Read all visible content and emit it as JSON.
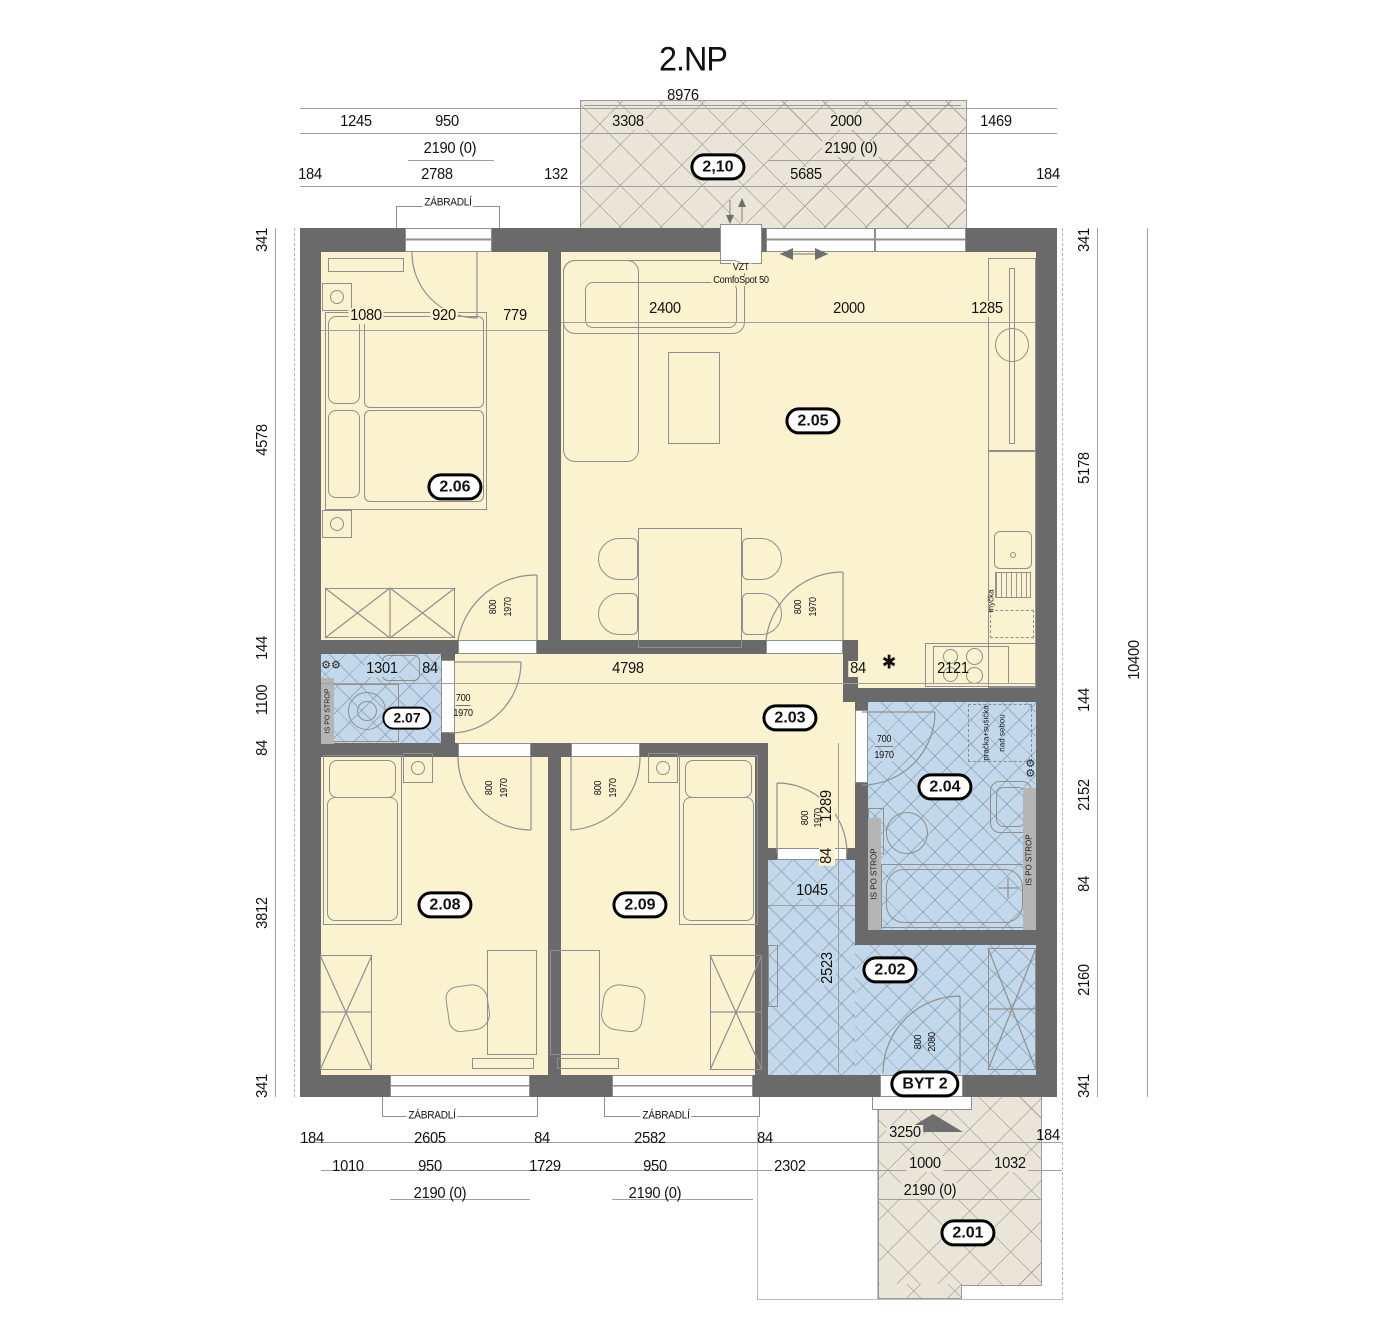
{
  "title": "2.NP",
  "rooms": {
    "r210": "2,10",
    "r205": "2.05",
    "r206": "2.06",
    "r207": "2.07",
    "r203": "2.03",
    "r204": "2.04",
    "r208": "2.08",
    "r209": "2.09",
    "r202": "2.02",
    "r201": "2.01",
    "byt": "BYT 2"
  },
  "dims": {
    "top_total": "8976",
    "t1a": "1245",
    "t1b": "950",
    "t1c": "3308",
    "t1d": "2000",
    "t1e": "1469",
    "t2a": "2190 (0)",
    "t2b": "2190 (0)",
    "t3a": "184",
    "t3b": "2788",
    "t3c": "132",
    "t3d": "5685",
    "t3e": "184",
    "l1": "341",
    "l2": "4578",
    "l3": "144",
    "l4": "1100",
    "l5": "84",
    "l6": "3812",
    "l7": "341",
    "r1": "341",
    "r2": "5178",
    "r3": "144",
    "r4": "2152",
    "r5": "84",
    "r6": "2160",
    "r7": "341",
    "right_total": "10400",
    "m206a": "1080",
    "m206b": "920",
    "m206c": "779",
    "m205a": "2400",
    "m205b": "2000",
    "m205c": "1285",
    "mida": "1301",
    "midb": "84",
    "midc": "4798",
    "midd": "84",
    "mide": "2121",
    "v1289": "1289",
    "v84": "84",
    "h1045": "1045",
    "v2523": "2523",
    "b1a": "184",
    "b1b": "2605",
    "b1c": "84",
    "b1d": "2582",
    "b1e": "84",
    "b1f": "3250",
    "b1g": "184",
    "b2a": "1010",
    "b2b": "950",
    "b2c": "1729",
    "b2d": "950",
    "b2e": "2302",
    "b2f": "1000",
    "b2g": "1032",
    "b3a": "2190 (0)",
    "b3b": "2190 (0)",
    "b3c": "2190 (0)"
  },
  "doors": {
    "d206w": "800",
    "d206h": "1970",
    "d205w": "800",
    "d205h": "1970",
    "d207w": "700",
    "d207h": "1970",
    "d204w": "700",
    "d204h": "1970",
    "d208w": "800",
    "d208h": "1970",
    "d209w": "800",
    "d209h": "1970",
    "d202w": "800",
    "d202h": "1970",
    "entryw": "800",
    "entryh": "2080",
    "v1289w": "800",
    "v1289h": "1970"
  },
  "labels": {
    "zabradli": "ZÁBRADLÍ",
    "vzt_line1": "VZT",
    "vzt_line2": "ComfoSpot 50",
    "is_po_strop": "IS PO STROP",
    "washer_line1": "pračka+sušička",
    "washer_line2": "nad sebou",
    "mycka": "myčka",
    "star": "✱"
  },
  "colors": {
    "wall": "#6a6a6a",
    "room_yellow": "#fbf2cf",
    "room_blue": "#c3d9eb",
    "balcony": "#e9e5d9",
    "furniture_line": "#8f8f8f",
    "dim_line": "#a0a0a0"
  }
}
